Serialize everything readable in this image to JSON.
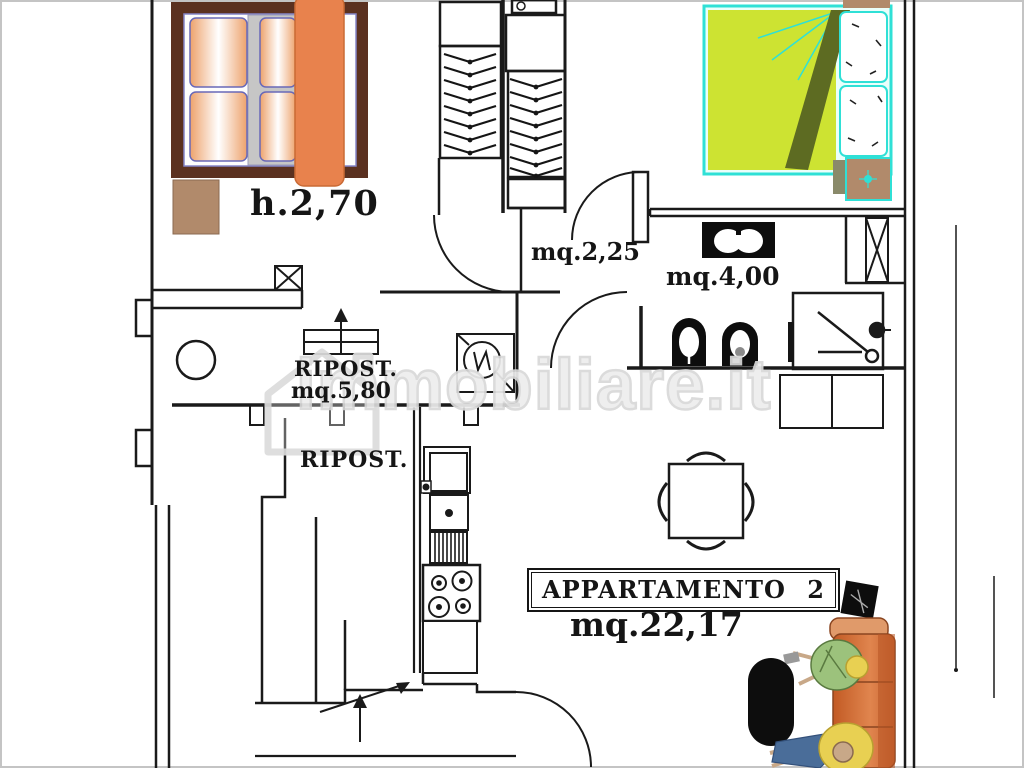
{
  "labels": {
    "room_height": "h.2,70",
    "hall_area": "mq.2,25",
    "bath_area": "mq.4,00",
    "storage_label": "RIPOST.",
    "storage_area": "mq.5,80",
    "storage2_label": "RIPOST.",
    "apartment_name": "APPARTAMENTO 2",
    "apartment_area": "mq.22,17"
  },
  "watermark": {
    "text": "immobiliare.it"
  },
  "colors": {
    "wall": "#1a1a1a",
    "bed_frame": "#5b3120",
    "bed_blanket": "#e8824d",
    "pillow_edge": "#f0a873",
    "sheet_gray": "#c6c6c6",
    "nightstand": "#b18a6b",
    "bed2_cover": "#cde332",
    "bed2_trim": "#2fe0d6",
    "bed2_fold": "#5d6b22",
    "sofa_main": "#d4703a",
    "sofa_dark": "#b85525",
    "person_green": "#9cc27c",
    "person_yellow": "#e8d052",
    "pants_blue": "#4a6d99",
    "skin": "#c8a888",
    "fixture_black": "#0d0d0d",
    "watermark": "#d8d8d8"
  }
}
